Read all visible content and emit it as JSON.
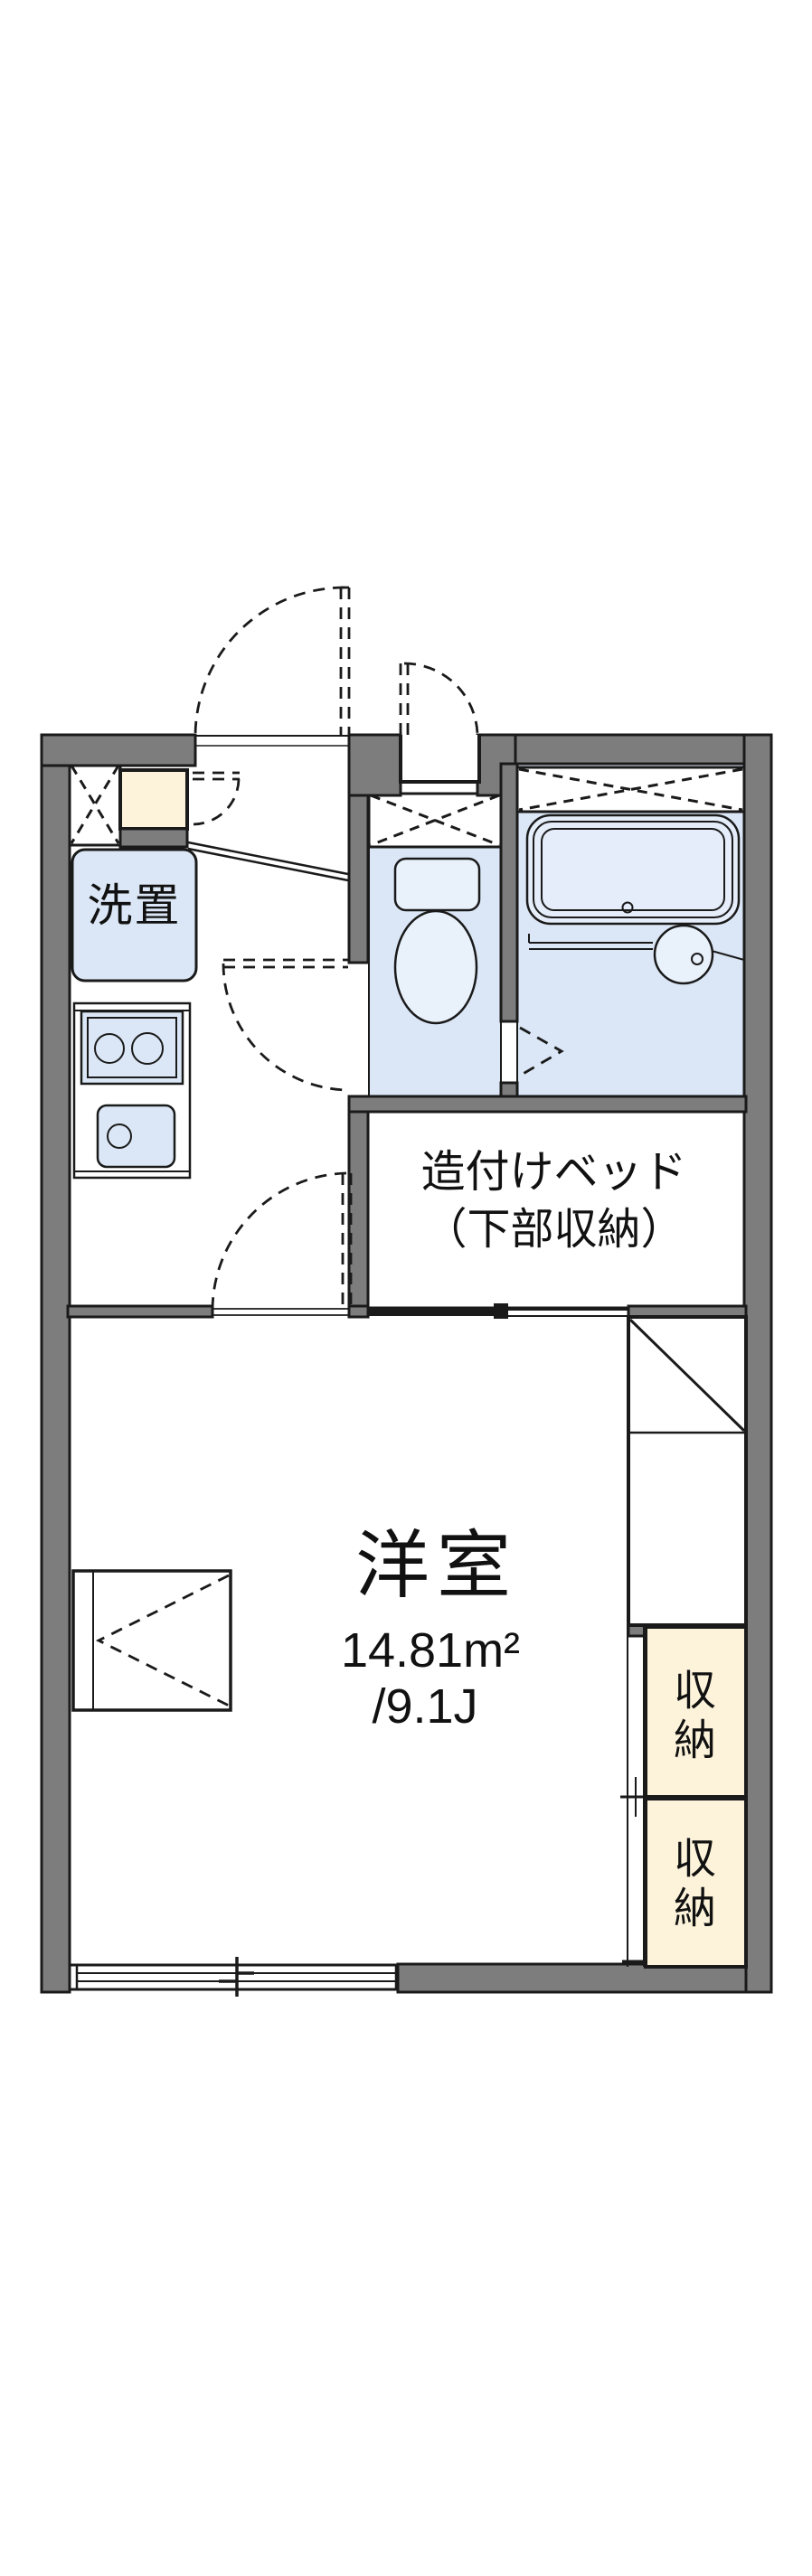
{
  "colors": {
    "wall": "#7d7d7d",
    "line": "#1a1a1a",
    "floor": "#dbe7f6",
    "fixture": "#e9f1fb",
    "tub": "#e4edf9",
    "cream": "#fcf3da"
  },
  "plan": {
    "laundry_label": "洗置",
    "bed_label_line1": "造付けベッド",
    "bed_label_line2": "（下部収納）",
    "main_room": {
      "name": "洋室",
      "area_m2": "14.81m²",
      "area_tatami": "/9.1J"
    },
    "storage_upper_label": "収納",
    "storage_lower_label": "収納"
  }
}
